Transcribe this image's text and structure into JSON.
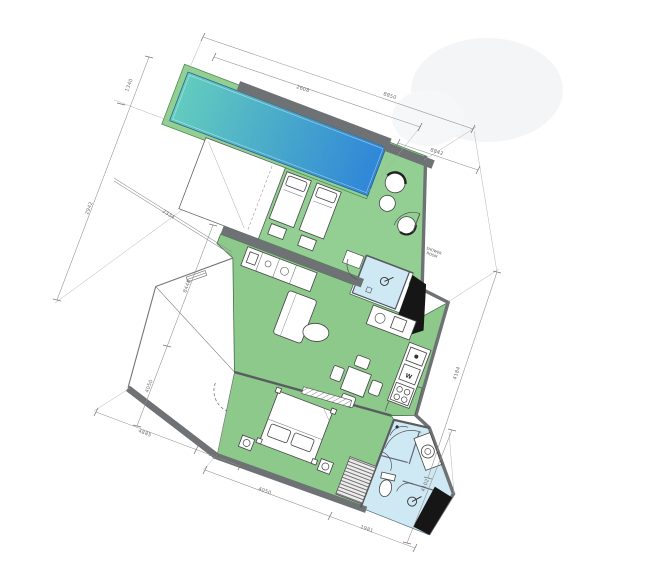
{
  "colors": {
    "room_green": "#8cc98b",
    "deck_green": "#93cf92",
    "deck_edge": "#4e8b51",
    "pool_start": "#63ccbe",
    "pool_end": "#2f86d8",
    "bath_blue": "#cfe9f4",
    "wall_gray": "#6e7274",
    "shaft_black": "#161616",
    "dim_line": "#8f8f8f"
  },
  "plan": {
    "annotations": {
      "outside_label_line1": "SHOWER",
      "outside_label_line2": "ROOM",
      "washer_label": "W"
    },
    "dimensions": {
      "top_outer": "8850",
      "top_inner": "2608",
      "top_right": "8842",
      "left_pool_width": "1340",
      "left_upper": "2942",
      "left_diagonal": "2334",
      "left_mid": "8448",
      "left_lower": "4050",
      "bottom_left": "4885",
      "bottom_left_small": "1180",
      "bottom_long": "4050",
      "bottom_right": "1981",
      "right_mid": "4184",
      "right_lower": "4102"
    }
  }
}
